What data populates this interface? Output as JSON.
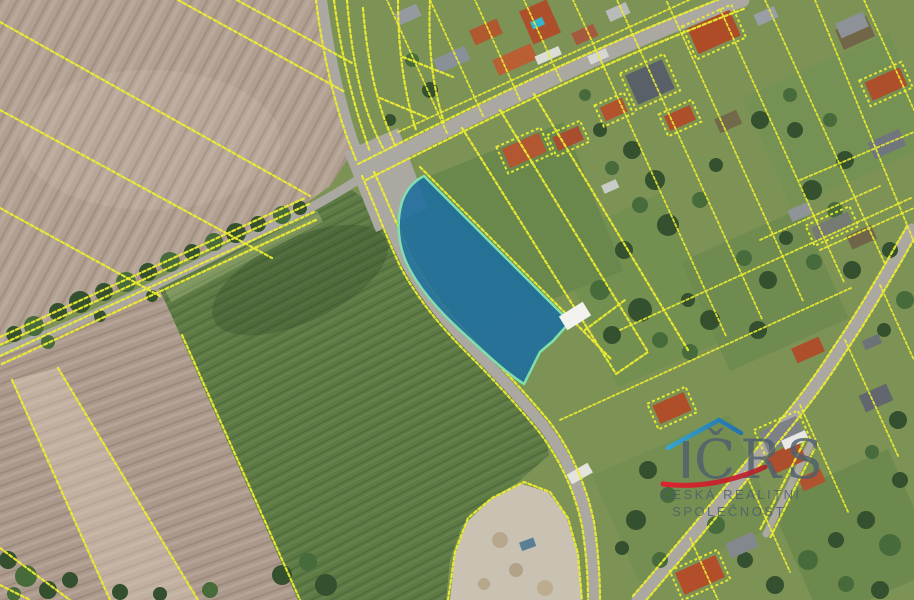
{
  "page": {
    "title": "Aerial cadastral map with highlighted parcel"
  },
  "watermark": {
    "logo_text": "ČRS",
    "line1": "ČESKÁ REALITNÍ",
    "line2": "SPOLEČNOST"
  },
  "map": {
    "cadastral_line_color": "#ecec32",
    "road_color": "#aaa8a0",
    "field_brown_nw": "#b1a092",
    "field_brown_sw": "#ab9a8c",
    "field_green": "#5d7a45",
    "village_green": "#7d9355",
    "gravel": "#c9c2b2",
    "roof_red": "#ad4f2a",
    "roof_gray": "#6b7077",
    "highlighted_parcel": {
      "fill": "#1f6f9e",
      "stroke": "#7fe0ad"
    },
    "logo_roof_light": "#2fa8e0",
    "logo_roof_dark": "#1a6fb4",
    "logo_swoosh_start": "#e8192c",
    "logo_swoosh_end": "#b51f2c",
    "logo_text_color": "#4f5f6e"
  }
}
